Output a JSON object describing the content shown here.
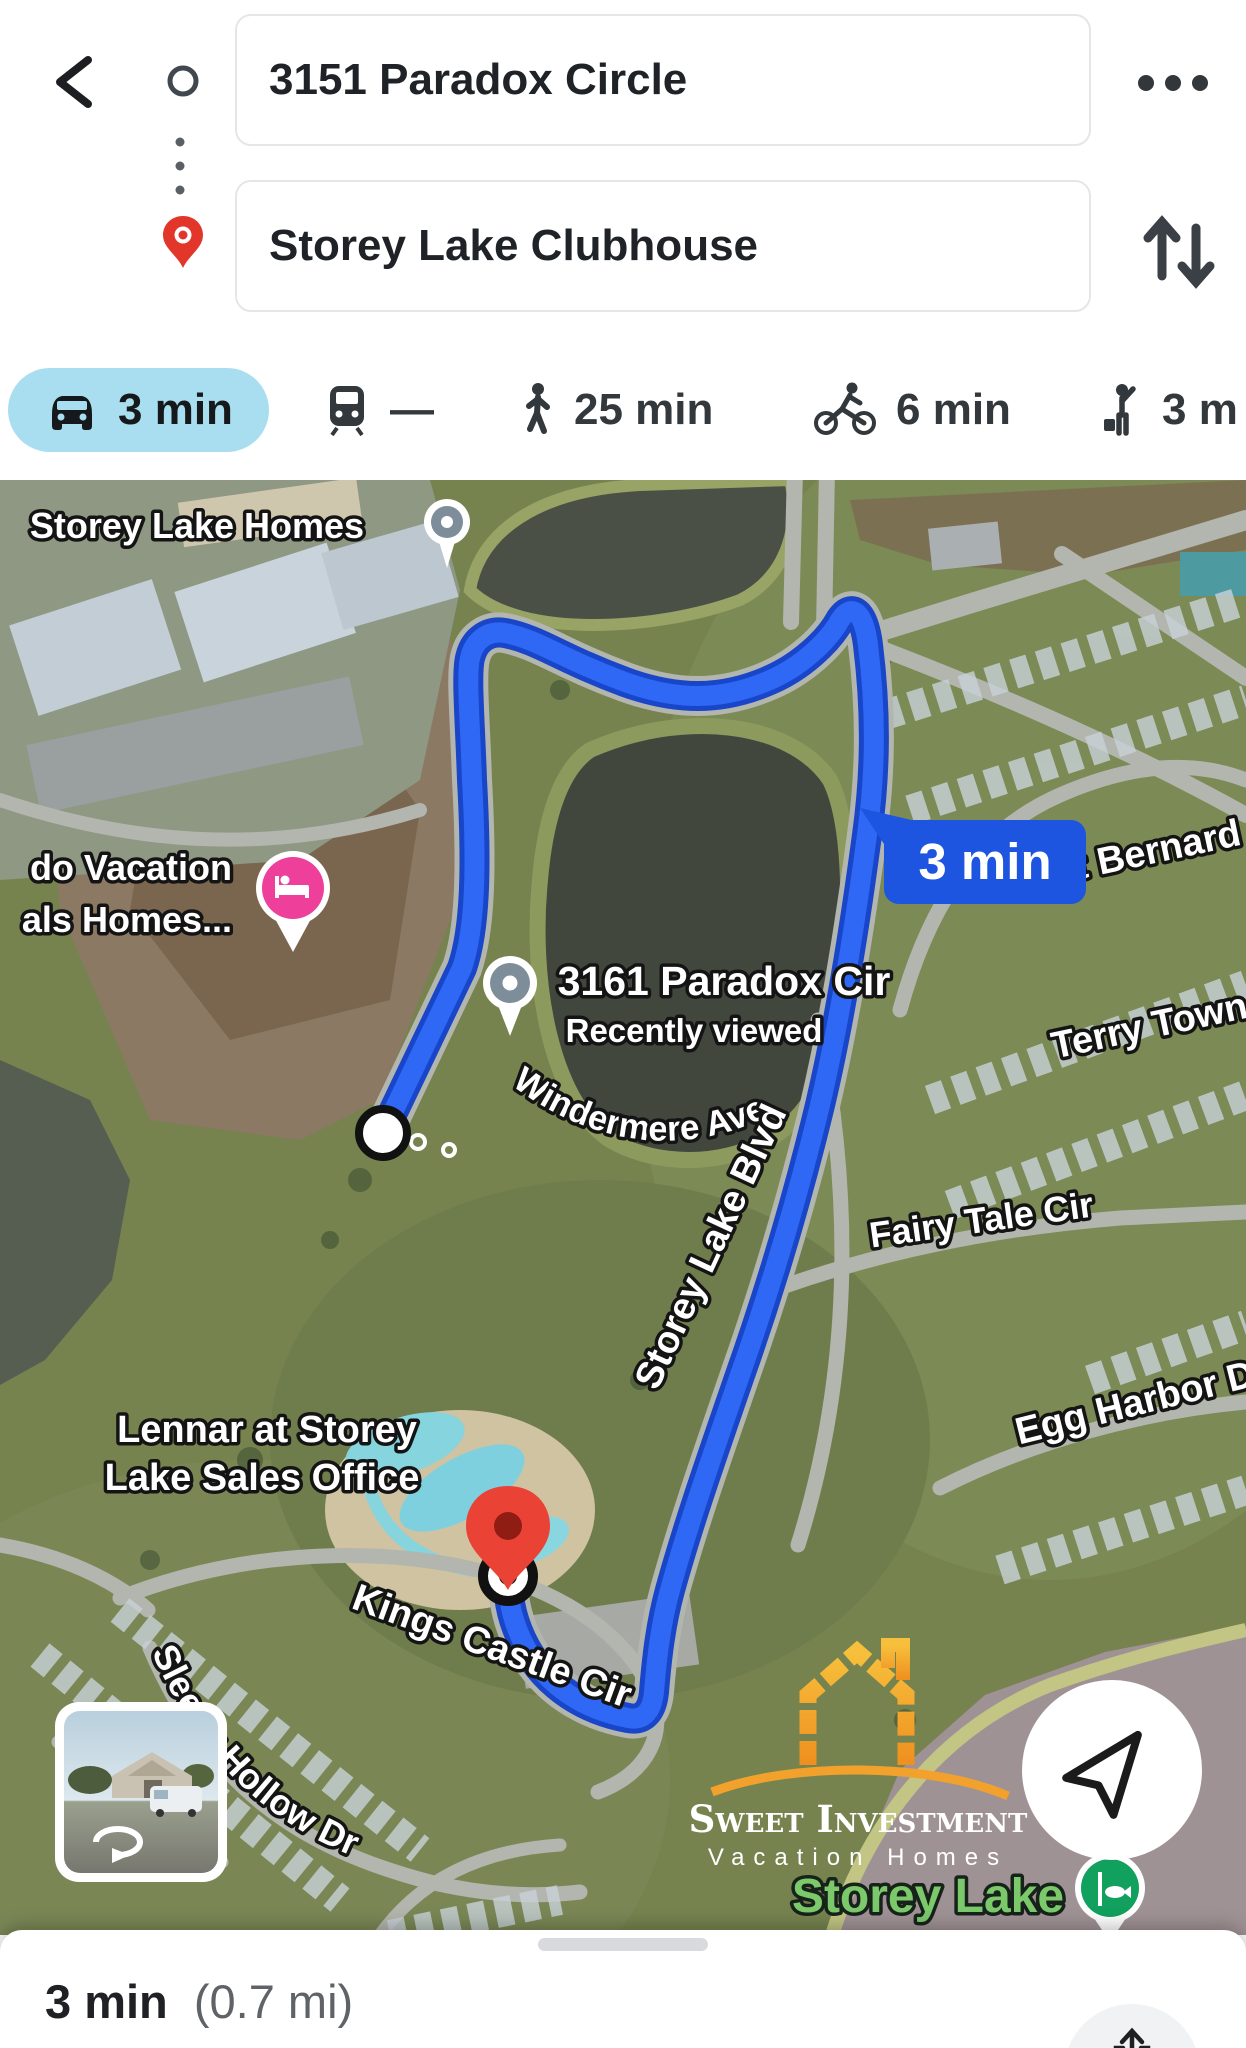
{
  "header": {
    "origin_value": "3151 Paradox Circle",
    "destination_value": "Storey Lake Clubhouse"
  },
  "modes": [
    {
      "id": "drive",
      "label": "3 min",
      "selected": true
    },
    {
      "id": "transit",
      "label": "—",
      "selected": false
    },
    {
      "id": "walk",
      "label": "25 min",
      "selected": false
    },
    {
      "id": "bike",
      "label": "6 min",
      "selected": false
    },
    {
      "id": "ride",
      "label": "3 m",
      "selected": false
    }
  ],
  "map": {
    "route_callout": "3 min",
    "labels": {
      "storey_lake_homes": "Storey Lake Homes",
      "windermere_ave": "Windermere Ave",
      "vacation_line1": "do Vacation",
      "vacation_line2": "als Homes...",
      "paradox_title": "3161 Paradox Cir",
      "paradox_subtitle": "Recently viewed",
      "st_bernard": "t Bernard",
      "terry_town": "Terry Town",
      "storey_lake_blvd": "Storey Lake Blvd",
      "fairy_tale_cir": "Fairy Tale Cir",
      "egg_harbor": "Egg Harbor D",
      "lennar_line1": "Lennar at Storey",
      "lennar_line2": "Lake Sales Office",
      "kings_castle_cir": "Kings Castle Cir",
      "sleepy_hollow_dr": "Sleepy Hollow Dr",
      "storey_lake_green": "Storey Lake"
    },
    "watermark": {
      "line1": "Sweet Investment",
      "line2": "Vacation Homes"
    },
    "colors": {
      "route": "#2e68f5",
      "route_casing": "#1945c8",
      "callout": "#1d55e0",
      "selected_chip": "#a9def0",
      "hotel_pin": "#ee3f9b",
      "poi_pin": "#7d8d99",
      "destination_pin": "#ea4335",
      "fishing_pin": "#12a05e"
    }
  },
  "footer": {
    "duration": "3 min",
    "distance": "(0.7 mi)"
  }
}
